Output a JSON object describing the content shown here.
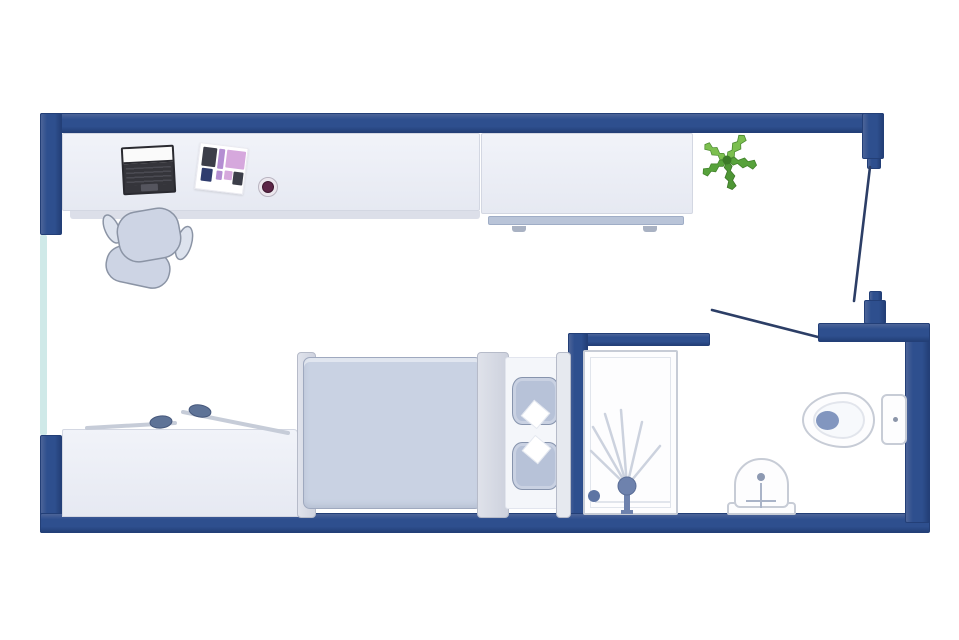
{
  "image": {
    "kind": "studio-apartment-floor-plan",
    "visible_text": [],
    "rooms": [
      "main-room",
      "bathroom"
    ],
    "openings": [
      "entry-door",
      "bathroom-door",
      "window"
    ],
    "furniture_main_room": [
      "desk",
      "office-chair",
      "laptop",
      "moodboard",
      "mug",
      "wardrobe",
      "potted-plant",
      "double-bed",
      "duvet",
      "pillow",
      "pillow",
      "storage-bench"
    ],
    "fixtures_bathroom": [
      "shower",
      "washbasin",
      "toilet",
      "cistern"
    ]
  },
  "colors": {
    "canvas-bg": "#ffffff",
    "wall": "#2e4f8e",
    "wall-dark": "#233f77",
    "wall-light": "#4c6498",
    "window": "#cfe9e8",
    "furniture-border": "#d3d7e2",
    "furniture-shadow": "#dcdfe9",
    "rail": "#b9c4d8",
    "bed-duvet": "#c9d2e3",
    "bed-duvet-border": "#9fa9bf",
    "bed-frame-border": "#b6bbc9",
    "mattress": "#f4f6fa",
    "pillow": "#b7c2d8",
    "pillow-border": "#8794ad",
    "chair-fill": "#cdd4e4",
    "chair-border": "#8b94a5",
    "laptop-body": "#35353b",
    "laptop-screen": "#fafafa",
    "fixture-fill": "#fdfdfe",
    "fixture-border": "#c7ccd6",
    "fixture-accent": "#6e82ad",
    "spray-line": "#ccd2de",
    "door-line": "#2c3e66",
    "plant-green-dark": "#4e9635",
    "plant-green": "#57a23b",
    "plant-green-light": "#7cbf4f",
    "plant-core": "#3c7a28",
    "mug-dark": "#5c2547",
    "moodboard-pink": "#d6a8dd",
    "moodboard-lilac": "#b48ed2",
    "moodboard-dark": "#3c3e49",
    "moodboard-navy": "#2f3c6e",
    "handle-knob": "#5e7397",
    "handle-rod": "#c6ccd8"
  }
}
